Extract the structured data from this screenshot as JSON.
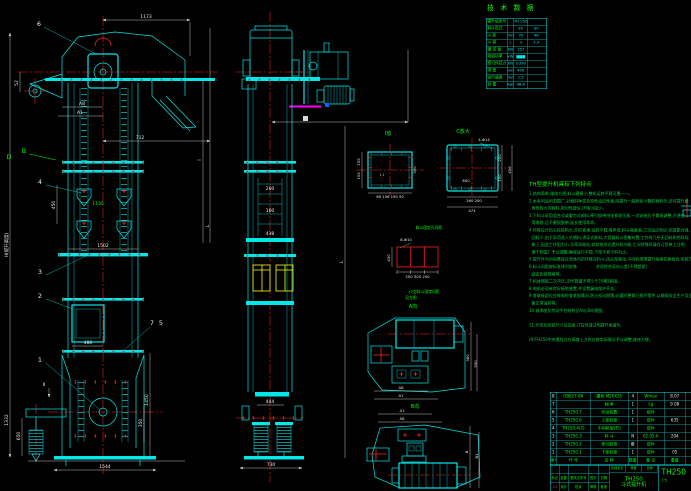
{
  "tech_table": {
    "title": "技 术 数 据",
    "rows": [
      {
        "l": "提升机型号",
        "u": "",
        "a": "TH 250",
        "b": ""
      },
      {
        "l": "料斗形式",
        "u": "",
        "a": "Zh",
        "b": "Sh"
      },
      {
        "l": "斗 距",
        "u": "mm",
        "a": "35",
        "b": "48"
      },
      {
        "l": "斗 容",
        "u": "L",
        "a": "3",
        "b": "1.3"
      },
      {
        "l": "输 送 量",
        "u": "kN",
        "a": "157",
        "b": ""
      },
      {
        "l": "电机功率",
        "u": "kW",
        "a": "▆▆▆",
        "b": ""
      },
      {
        "l": "牵引件拉力",
        "u": "kN",
        "a": "≥330",
        "b": ""
      },
      {
        "l": "带 宽",
        "u": "mm",
        "a": "400",
        "b": ""
      },
      {
        "l": "运行速度",
        "u": "m/s",
        "a": "1.5",
        "b": ""
      },
      {
        "l": "自 重",
        "u": "kg/m",
        "a": "48.8",
        "b": ""
      }
    ]
  },
  "notes": {
    "title": "TH型提升机具有下列特点",
    "lines": [
      "1.结构简单,维修方便,料斗磨损小,整机运转平稳可靠一一。",
      "2.本系列适用范围广,对物料种类及特性适应性强,除提升一般粉状小颗粒物料外,还可提升磨",
      "  琢性较大的物料,密封性能好,环境污染少。",
      "3.下料斗采用混合式或重力式卸料,牵引胶带由张紧轮压紧,一次安装后不需再调整,方便使",
      "  用维修,且不磨损胶带,延长使用寿命。",
      "4.特殊设计的头轮结构大,外形紧凑,运转平稳,噪声低,料斗强度高,工况适应性好,挖取能力强,",
      "  回料少,由于采用流入式喂料,诱导式卸料,大容量料斗密集布置,工作时几乎无回料和挖料现",
      "  象上,因此工作阻力小,功率消耗低,较其他形式提升机节能,工况特殊时请在订货单上注明,",
      "  便于制造厂予以调整,确保运行平稳,下部不易卡料为止。",
      "5.提升件为自由悬挂在壳体内的环链及料斗,由头部驱动,中间机架随提升高度任意组合,安装方便",
      "6.料斗间距按标准排列安装               并须符合双向公差(不得超差)",
      "  固定安装规格等。",
      "7.机体钢板二次冲压,正H(数量不得少于16套)紧固。",
      "8.电机必须有良好接地装置,并设置漏电保护开关。",
      "9.各联接部位应每周检查紧固情况,防止松动脱落,必要时更换已损坏零件,以确保安全生产及设",
      "  备正常运转等。",
      "10.轴承座及传动平台结构见A向,B向视图。",
      "",
      "11.外形及安装尺寸见总图,订货时请注明提升高度H。",
      "",
      "(9)TH250中央悬挂点在高度上方时应按实际情况予以调整,维修方便。"
    ]
  },
  "bom": {
    "headers": [
      "序号",
      "代 号",
      "名 称",
      "数量",
      "备 注",
      "重量",
      ""
    ],
    "rows": [
      {
        "n": "8",
        "c": "GB827-86",
        "m": "螺栓 M20X35",
        "q": "4",
        "r": "Wmax",
        "w": "8.07"
      },
      {
        "n": "7",
        "c": "",
        "m": "轴 承",
        "q": "1",
        "r": "Lg",
        "w": "9.08"
      },
      {
        "n": "6",
        "c": "TH250.7",
        "m": "传动装置",
        "q": "1",
        "r": "组件",
        "w": ""
      },
      {
        "n": "5",
        "c": "TH250.6",
        "m": "上部机架",
        "q": "1",
        "r": "部件",
        "w": "635"
      },
      {
        "n": "4",
        "c": "TH250.4(3)",
        "m": "中间机架(节)",
        "q": "",
        "r": "部件",
        "w": ""
      },
      {
        "n": "3",
        "c": "TH250.3",
        "m": "料 斗",
        "q": "N",
        "r": "02.05-A",
        "w": "204"
      },
      {
        "n": "2",
        "c": "TH250.2",
        "m": "牵引胶带",
        "q": "套",
        "r": "部件",
        "w": ""
      },
      {
        "n": "1",
        "c": "TH250.1",
        "m": "下部机架",
        "q": "1",
        "r": "部件",
        "w": "05"
      }
    ]
  },
  "title_block": {
    "product_model": "TH250",
    "product_name": "斗式提升机",
    "drawing_no": "TH250",
    "scale": "1:5",
    "rev_row": [
      "标记",
      "处数",
      "更改文件号",
      "签字",
      "日期"
    ],
    "sign_row": [
      "设计",
      "校对",
      "审核",
      "批准"
    ],
    "stage_row": [
      "阶段标记",
      "质量",
      "比例"
    ]
  },
  "labels": {
    "v1173": "1173",
    "v712": "712",
    "a8": "A8",
    "a1": "A1",
    "v52": "52",
    "vH": "H(提升高度)",
    "v450": "450",
    "v1130": "1130",
    "v1502": "1502",
    "v480": "480",
    "v1450": "1450",
    "v350": "350",
    "v1332": "1332",
    "v650": "650",
    "v1544": "1544",
    "vL": "L",
    "vl": "l",
    "vII": "Ⅱ",
    "c6": "6",
    "c4": "4",
    "c3": "3",
    "c2": "2",
    "c1": "1",
    "c7": "7",
    "c5": "5",
    "gB": "B",
    "gD": "D",
    "v260": "260",
    "v160": "160",
    "v438": "438",
    "v444": "444",
    "v730": "730",
    "vLm": "L",
    "secI": "I放",
    "secIdims": "98 156 195 92",
    "s155a": "155",
    "s155b": "155",
    "s390": "390",
    "sII": "I-I",
    "secC": "C放大",
    "c414": "4-Φ14",
    "c600": "600",
    "c260200": "260 200",
    "c474": "474",
    "c200": "200",
    "c150": "150",
    "c456": "456",
    "bkT": "料斗固定孔间距",
    "bk8": "8-Φ10",
    "bk430": "430",
    "bkD": "200 300 200",
    "bkN1": "Y2型料斗固定间距",
    "bkN2": "见左图",
    "vA": "A向",
    "vB": "B向",
    "aA8": "A8",
    "aA1": "A1",
    "a380": "380",
    "a550": "550",
    "bA1": "A1",
    "bA8": "A8",
    "bB": "B",
    "bB1": "B1"
  }
}
